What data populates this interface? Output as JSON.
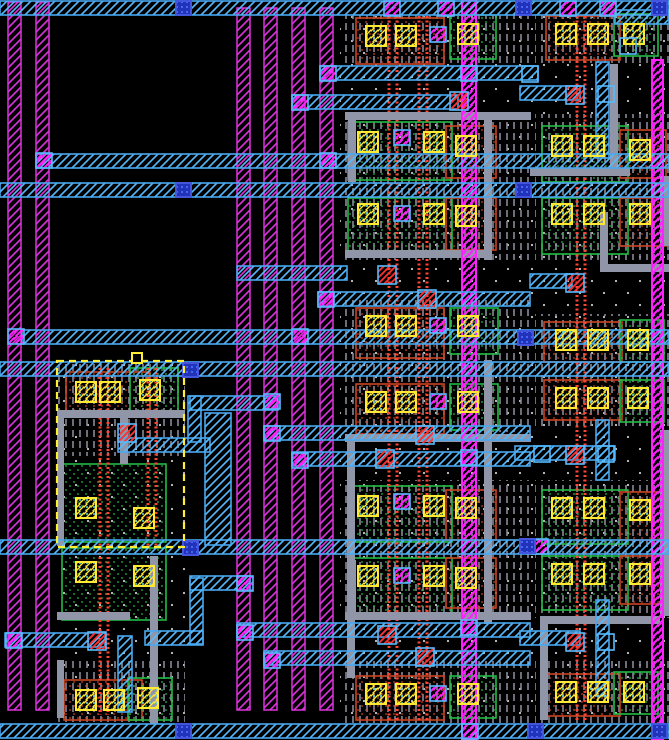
{
  "app": {
    "name": "ic-layout-canvas",
    "view": "vlsi-mask-layout"
  },
  "canvas": {
    "width": 669,
    "height": 740,
    "background": "#000000"
  },
  "palette": {
    "metal1_magenta": "#DD33DD",
    "metal1_bright": "#FF22FF",
    "metal2_cyan": "#49A8F0",
    "metal2_hatch": "#55BBFF",
    "well_gray": "#8A8A9A",
    "route_gray": "#9096A8",
    "ndiff_green": "#22BB44",
    "pdiff_orange": "#CC4422",
    "poly_red": "#FF4433",
    "contact_yellow": "#FFE933",
    "contact_speck": "#66E0E0",
    "via_blue_fill": "#2233BB",
    "via_blue_dot": "#5577FF",
    "via_blue_stroke": "#4455DD",
    "red_contact": "#FF3030",
    "dot_white": "#C8C8C8",
    "selection_yellow": "#FFEE33"
  },
  "layout": {
    "dots_regions": [
      {
        "x": 340,
        "y": 15,
        "w": 190,
        "h": 709
      },
      {
        "x": 530,
        "y": 15,
        "w": 139,
        "h": 709
      },
      {
        "x": 57,
        "y": 362,
        "w": 128,
        "h": 360
      }
    ],
    "wells": [
      {
        "x": 345,
        "y": 15,
        "w": 185,
        "h": 50
      },
      {
        "x": 345,
        "y": 114,
        "w": 185,
        "h": 146
      },
      {
        "x": 345,
        "y": 300,
        "w": 185,
        "h": 132
      },
      {
        "x": 345,
        "y": 480,
        "w": 185,
        "h": 138
      },
      {
        "x": 345,
        "y": 658,
        "w": 185,
        "h": 66
      },
      {
        "x": 535,
        "y": 15,
        "w": 134,
        "h": 50
      },
      {
        "x": 535,
        "y": 114,
        "w": 134,
        "h": 146
      },
      {
        "x": 535,
        "y": 314,
        "w": 134,
        "h": 114
      },
      {
        "x": 535,
        "y": 480,
        "w": 134,
        "h": 138
      },
      {
        "x": 535,
        "y": 658,
        "w": 134,
        "h": 66
      },
      {
        "x": 57,
        "y": 362,
        "w": 128,
        "h": 94
      },
      {
        "x": 57,
        "y": 658,
        "w": 128,
        "h": 64
      }
    ],
    "diffusions": [
      {
        "x": 356,
        "y": 18,
        "w": 88,
        "h": 46,
        "kind": "p"
      },
      {
        "x": 450,
        "y": 15,
        "w": 46,
        "h": 44,
        "kind": "n"
      },
      {
        "x": 348,
        "y": 122,
        "w": 104,
        "h": 58,
        "kind": "n"
      },
      {
        "x": 446,
        "y": 126,
        "w": 50,
        "h": 52,
        "kind": "p"
      },
      {
        "x": 348,
        "y": 198,
        "w": 104,
        "h": 58,
        "kind": "n"
      },
      {
        "x": 446,
        "y": 198,
        "w": 50,
        "h": 52,
        "kind": "p"
      },
      {
        "x": 356,
        "y": 308,
        "w": 88,
        "h": 50,
        "kind": "p"
      },
      {
        "x": 450,
        "y": 308,
        "w": 48,
        "h": 46,
        "kind": "n"
      },
      {
        "x": 356,
        "y": 384,
        "w": 88,
        "h": 50,
        "kind": "p"
      },
      {
        "x": 450,
        "y": 384,
        "w": 48,
        "h": 46,
        "kind": "n"
      },
      {
        "x": 348,
        "y": 486,
        "w": 104,
        "h": 56,
        "kind": "n"
      },
      {
        "x": 446,
        "y": 490,
        "w": 50,
        "h": 50,
        "kind": "p"
      },
      {
        "x": 348,
        "y": 558,
        "w": 104,
        "h": 56,
        "kind": "n"
      },
      {
        "x": 446,
        "y": 558,
        "w": 50,
        "h": 50,
        "kind": "p"
      },
      {
        "x": 356,
        "y": 676,
        "w": 88,
        "h": 44,
        "kind": "p"
      },
      {
        "x": 450,
        "y": 676,
        "w": 46,
        "h": 42,
        "kind": "n"
      },
      {
        "x": 546,
        "y": 16,
        "w": 74,
        "h": 44,
        "kind": "p"
      },
      {
        "x": 614,
        "y": 14,
        "w": 44,
        "h": 42,
        "kind": "n"
      },
      {
        "x": 542,
        "y": 126,
        "w": 86,
        "h": 56,
        "kind": "n"
      },
      {
        "x": 620,
        "y": 130,
        "w": 46,
        "h": 48,
        "kind": "p"
      },
      {
        "x": 542,
        "y": 198,
        "w": 86,
        "h": 56,
        "kind": "n"
      },
      {
        "x": 620,
        "y": 198,
        "w": 46,
        "h": 48,
        "kind": "p"
      },
      {
        "x": 544,
        "y": 322,
        "w": 78,
        "h": 40,
        "kind": "p"
      },
      {
        "x": 620,
        "y": 320,
        "w": 44,
        "h": 42,
        "kind": "n"
      },
      {
        "x": 544,
        "y": 380,
        "w": 78,
        "h": 40,
        "kind": "p"
      },
      {
        "x": 620,
        "y": 380,
        "w": 44,
        "h": 42,
        "kind": "n"
      },
      {
        "x": 542,
        "y": 490,
        "w": 86,
        "h": 54,
        "kind": "n"
      },
      {
        "x": 620,
        "y": 492,
        "w": 46,
        "h": 48,
        "kind": "p"
      },
      {
        "x": 542,
        "y": 556,
        "w": 86,
        "h": 54,
        "kind": "n"
      },
      {
        "x": 620,
        "y": 556,
        "w": 46,
        "h": 48,
        "kind": "p"
      },
      {
        "x": 546,
        "y": 674,
        "w": 74,
        "h": 42,
        "kind": "p"
      },
      {
        "x": 614,
        "y": 672,
        "w": 44,
        "h": 42,
        "kind": "n"
      },
      {
        "x": 66,
        "y": 372,
        "w": 84,
        "h": 44,
        "kind": "p"
      },
      {
        "x": 130,
        "y": 368,
        "w": 48,
        "h": 46,
        "kind": "n"
      },
      {
        "x": 62,
        "y": 464,
        "w": 104,
        "h": 78,
        "kind": "n"
      },
      {
        "x": 62,
        "y": 548,
        "w": 104,
        "h": 72,
        "kind": "n"
      },
      {
        "x": 64,
        "y": 680,
        "w": 78,
        "h": 40,
        "kind": "p"
      },
      {
        "x": 128,
        "y": 678,
        "w": 44,
        "h": 42,
        "kind": "n"
      }
    ],
    "poly_pairs": [
      {
        "x": 389,
        "y1": 16,
        "y2": 722
      },
      {
        "x": 419,
        "y1": 16,
        "y2": 722
      },
      {
        "x": 577,
        "y1": 16,
        "y2": 722
      },
      {
        "x": 100,
        "y1": 368,
        "y2": 715
      },
      {
        "x": 148,
        "y1": 368,
        "y2": 548
      }
    ],
    "gray_routes": [
      {
        "x": 345,
        "y": 112,
        "w": 186,
        "h": 8
      },
      {
        "x": 484,
        "y": 120,
        "w": 8,
        "h": 140
      },
      {
        "x": 345,
        "y": 250,
        "w": 145,
        "h": 8
      },
      {
        "x": 348,
        "y": 120,
        "w": 8,
        "h": 62
      },
      {
        "x": 345,
        "y": 434,
        "w": 186,
        "h": 8
      },
      {
        "x": 484,
        "y": 360,
        "w": 8,
        "h": 264
      },
      {
        "x": 345,
        "y": 612,
        "w": 186,
        "h": 8
      },
      {
        "x": 348,
        "y": 560,
        "w": 8,
        "h": 60
      },
      {
        "x": 530,
        "y": 168,
        "w": 100,
        "h": 8
      },
      {
        "x": 610,
        "y": 64,
        "w": 8,
        "h": 108
      },
      {
        "x": 660,
        "y": 176,
        "w": 9,
        "h": 70
      },
      {
        "x": 600,
        "y": 264,
        "w": 69,
        "h": 8
      },
      {
        "x": 600,
        "y": 212,
        "w": 8,
        "h": 60
      },
      {
        "x": 540,
        "y": 620,
        "w": 8,
        "h": 100
      },
      {
        "x": 540,
        "y": 616,
        "w": 120,
        "h": 8
      },
      {
        "x": 660,
        "y": 430,
        "w": 9,
        "h": 186
      },
      {
        "x": 57,
        "y": 410,
        "w": 128,
        "h": 8
      },
      {
        "x": 120,
        "y": 418,
        "w": 8,
        "h": 46
      },
      {
        "x": 57,
        "y": 612,
        "w": 73,
        "h": 8
      },
      {
        "x": 57,
        "y": 414,
        "w": 7,
        "h": 132
      },
      {
        "x": 150,
        "y": 556,
        "w": 8,
        "h": 168
      },
      {
        "x": 347,
        "y": 438,
        "w": 8,
        "h": 240
      },
      {
        "x": 57,
        "y": 660,
        "w": 7,
        "h": 58
      }
    ],
    "metal_v_stripes": [
      {
        "x": 8,
        "y": 2,
        "w": 13,
        "h": 708,
        "bright": false
      },
      {
        "x": 36,
        "y": 2,
        "w": 13,
        "h": 708,
        "bright": false
      },
      {
        "x": 237,
        "y": 8,
        "w": 13,
        "h": 702,
        "bright": false
      },
      {
        "x": 264,
        "y": 8,
        "w": 13,
        "h": 702,
        "bright": false
      },
      {
        "x": 292,
        "y": 8,
        "w": 13,
        "h": 702,
        "bright": false
      },
      {
        "x": 320,
        "y": 8,
        "w": 13,
        "h": 702,
        "bright": false
      },
      {
        "x": 462,
        "y": 0,
        "w": 14,
        "h": 740,
        "bright": true
      },
      {
        "x": 652,
        "y": 60,
        "w": 11,
        "h": 680,
        "bright": true
      }
    ],
    "metal_h_bands": [
      {
        "x": 0,
        "y": 1,
        "w": 669
      },
      {
        "x": 36,
        "y": 154,
        "w": 633
      },
      {
        "x": 0,
        "y": 183,
        "w": 669
      },
      {
        "x": 22,
        "y": 330,
        "w": 647
      },
      {
        "x": 0,
        "y": 362,
        "w": 669
      },
      {
        "x": 0,
        "y": 540,
        "w": 669
      },
      {
        "x": 0,
        "y": 724,
        "w": 669
      }
    ],
    "metal_h_segments": [
      {
        "x": 320,
        "y": 66,
        "w": 218
      },
      {
        "x": 292,
        "y": 95,
        "w": 166
      },
      {
        "x": 520,
        "y": 86,
        "w": 60
      },
      {
        "x": 615,
        "y": 10,
        "w": 54
      },
      {
        "x": 237,
        "y": 266,
        "w": 110
      },
      {
        "x": 318,
        "y": 292,
        "w": 212
      },
      {
        "x": 530,
        "y": 274,
        "w": 42
      },
      {
        "x": 190,
        "y": 396,
        "w": 88
      },
      {
        "x": 264,
        "y": 426,
        "w": 266
      },
      {
        "x": 292,
        "y": 452,
        "w": 238
      },
      {
        "x": 515,
        "y": 446,
        "w": 100
      },
      {
        "x": 118,
        "y": 438,
        "w": 92
      },
      {
        "x": 190,
        "y": 576,
        "w": 60
      },
      {
        "x": 145,
        "y": 631,
        "w": 58
      },
      {
        "x": 5,
        "y": 633,
        "w": 100
      },
      {
        "x": 237,
        "y": 623,
        "w": 293
      },
      {
        "x": 264,
        "y": 651,
        "w": 266
      },
      {
        "x": 520,
        "y": 631,
        "w": 60
      }
    ],
    "metal_v_segments": [
      {
        "x": 188,
        "y": 396,
        "w": 13,
        "h": 46
      },
      {
        "x": 205,
        "y": 413,
        "w": 26,
        "h": 132
      },
      {
        "x": 190,
        "y": 578,
        "w": 13,
        "h": 66
      },
      {
        "x": 118,
        "y": 636,
        "w": 14,
        "h": 76
      },
      {
        "x": 596,
        "y": 62,
        "w": 13,
        "h": 96
      },
      {
        "x": 596,
        "y": 420,
        "w": 13,
        "h": 60
      },
      {
        "x": 596,
        "y": 600,
        "w": 13,
        "h": 96
      }
    ],
    "contacts": [
      {
        "x": 366,
        "y": 26
      },
      {
        "x": 396,
        "y": 26
      },
      {
        "x": 458,
        "y": 24
      },
      {
        "x": 358,
        "y": 132
      },
      {
        "x": 424,
        "y": 132
      },
      {
        "x": 456,
        "y": 136
      },
      {
        "x": 358,
        "y": 204
      },
      {
        "x": 424,
        "y": 204
      },
      {
        "x": 456,
        "y": 206
      },
      {
        "x": 366,
        "y": 316
      },
      {
        "x": 396,
        "y": 316
      },
      {
        "x": 458,
        "y": 316
      },
      {
        "x": 366,
        "y": 392
      },
      {
        "x": 396,
        "y": 392
      },
      {
        "x": 458,
        "y": 392
      },
      {
        "x": 358,
        "y": 496
      },
      {
        "x": 424,
        "y": 496
      },
      {
        "x": 456,
        "y": 498
      },
      {
        "x": 358,
        "y": 566
      },
      {
        "x": 424,
        "y": 566
      },
      {
        "x": 456,
        "y": 568
      },
      {
        "x": 366,
        "y": 684
      },
      {
        "x": 396,
        "y": 684
      },
      {
        "x": 458,
        "y": 684
      },
      {
        "x": 556,
        "y": 24
      },
      {
        "x": 588,
        "y": 24
      },
      {
        "x": 624,
        "y": 24
      },
      {
        "x": 552,
        "y": 136
      },
      {
        "x": 584,
        "y": 136
      },
      {
        "x": 630,
        "y": 140
      },
      {
        "x": 552,
        "y": 204
      },
      {
        "x": 584,
        "y": 204
      },
      {
        "x": 630,
        "y": 204
      },
      {
        "x": 556,
        "y": 330
      },
      {
        "x": 588,
        "y": 330
      },
      {
        "x": 628,
        "y": 330
      },
      {
        "x": 556,
        "y": 388
      },
      {
        "x": 588,
        "y": 388
      },
      {
        "x": 628,
        "y": 388
      },
      {
        "x": 552,
        "y": 498
      },
      {
        "x": 584,
        "y": 498
      },
      {
        "x": 630,
        "y": 500
      },
      {
        "x": 552,
        "y": 564
      },
      {
        "x": 584,
        "y": 564
      },
      {
        "x": 630,
        "y": 564
      },
      {
        "x": 556,
        "y": 682
      },
      {
        "x": 588,
        "y": 682
      },
      {
        "x": 624,
        "y": 682
      },
      {
        "x": 76,
        "y": 382
      },
      {
        "x": 100,
        "y": 382
      },
      {
        "x": 140,
        "y": 380
      },
      {
        "x": 76,
        "y": 498
      },
      {
        "x": 134,
        "y": 508
      },
      {
        "x": 76,
        "y": 562
      },
      {
        "x": 134,
        "y": 566
      },
      {
        "x": 76,
        "y": 690
      },
      {
        "x": 104,
        "y": 690
      },
      {
        "x": 138,
        "y": 688
      }
    ],
    "vias_magenta": [
      {
        "x": 430,
        "y": 27
      },
      {
        "x": 394,
        "y": 130
      },
      {
        "x": 394,
        "y": 206
      },
      {
        "x": 430,
        "y": 318
      },
      {
        "x": 430,
        "y": 394
      },
      {
        "x": 394,
        "y": 494
      },
      {
        "x": 394,
        "y": 568
      },
      {
        "x": 430,
        "y": 686
      },
      {
        "x": 320,
        "y": 66
      },
      {
        "x": 292,
        "y": 95
      },
      {
        "x": 461,
        "y": 66
      },
      {
        "x": 36,
        "y": 153
      },
      {
        "x": 320,
        "y": 153
      },
      {
        "x": 8,
        "y": 329
      },
      {
        "x": 292,
        "y": 329
      },
      {
        "x": 318,
        "y": 292
      },
      {
        "x": 264,
        "y": 394
      },
      {
        "x": 264,
        "y": 426
      },
      {
        "x": 292,
        "y": 453
      },
      {
        "x": 461,
        "y": 450
      },
      {
        "x": 237,
        "y": 576
      },
      {
        "x": 237,
        "y": 625
      },
      {
        "x": 264,
        "y": 653
      },
      {
        "x": 6,
        "y": 633
      },
      {
        "x": 461,
        "y": 620
      },
      {
        "x": 384,
        "y": 1
      },
      {
        "x": 438,
        "y": 1
      },
      {
        "x": 560,
        "y": 1
      },
      {
        "x": 600,
        "y": 1
      },
      {
        "x": 462,
        "y": 724
      },
      {
        "x": 532,
        "y": 539
      }
    ],
    "vias_blue": [
      {
        "x": 176,
        "y": 1
      },
      {
        "x": 516,
        "y": 1
      },
      {
        "x": 652,
        "y": 1
      },
      {
        "x": 176,
        "y": 183
      },
      {
        "x": 516,
        "y": 183
      },
      {
        "x": 518,
        "y": 331
      },
      {
        "x": 183,
        "y": 363
      },
      {
        "x": 183,
        "y": 541
      },
      {
        "x": 520,
        "y": 539
      },
      {
        "x": 176,
        "y": 724
      },
      {
        "x": 528,
        "y": 724
      },
      {
        "x": 652,
        "y": 724
      }
    ],
    "contacts_red": [
      {
        "x": 450,
        "y": 92
      },
      {
        "x": 566,
        "y": 86
      },
      {
        "x": 378,
        "y": 266
      },
      {
        "x": 418,
        "y": 290
      },
      {
        "x": 566,
        "y": 274
      },
      {
        "x": 416,
        "y": 426
      },
      {
        "x": 376,
        "y": 450
      },
      {
        "x": 566,
        "y": 446
      },
      {
        "x": 118,
        "y": 424
      },
      {
        "x": 88,
        "y": 632
      },
      {
        "x": 378,
        "y": 626
      },
      {
        "x": 416,
        "y": 648
      },
      {
        "x": 566,
        "y": 633
      }
    ],
    "boxes_blue": [
      {
        "x": 522,
        "y": 66
      },
      {
        "x": 598,
        "y": 86
      },
      {
        "x": 598,
        "y": 446
      },
      {
        "x": 534,
        "y": 446
      },
      {
        "x": 598,
        "y": 634
      },
      {
        "x": 620,
        "y": 38
      }
    ],
    "selection": {
      "x": 57,
      "y": 361,
      "w": 127,
      "h": 186,
      "handle_x": 132,
      "handle_y": 353,
      "handle_size": 10
    }
  }
}
